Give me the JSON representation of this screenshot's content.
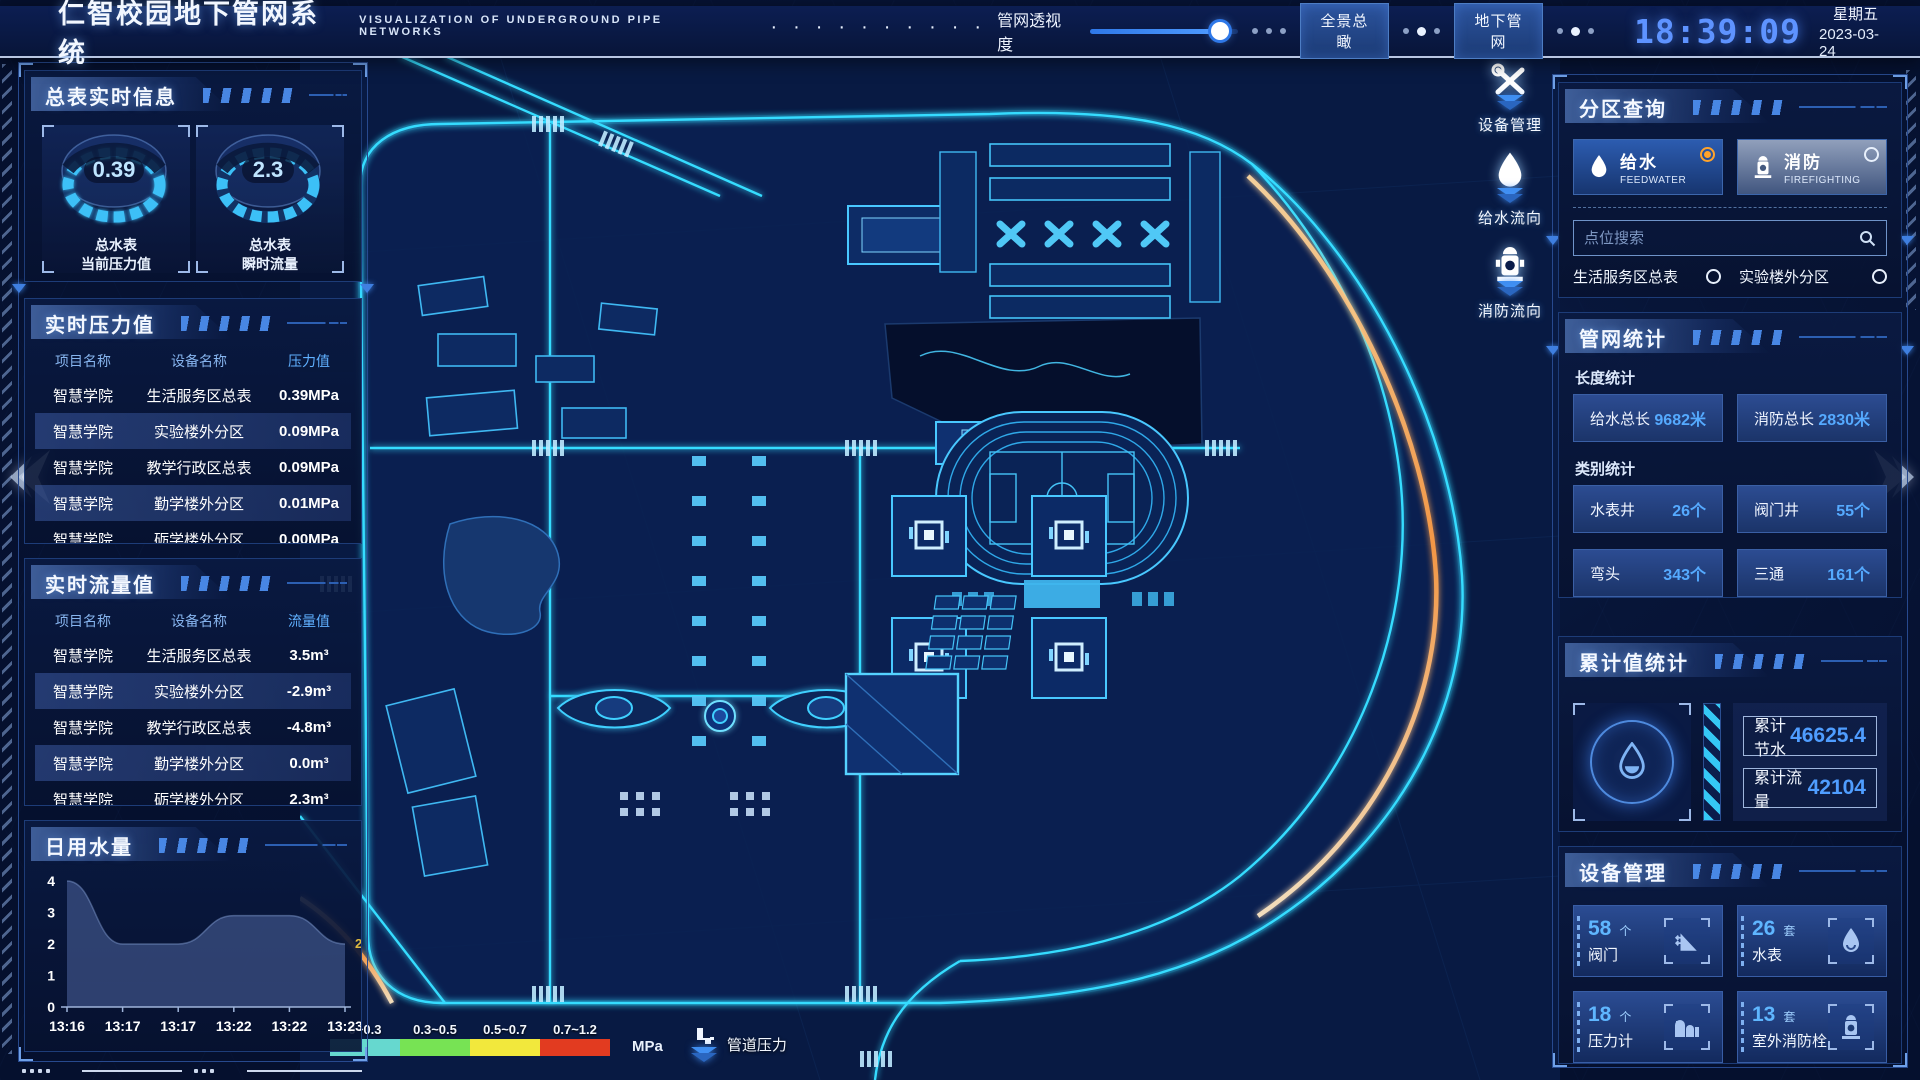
{
  "header": {
    "title_cn": "仁智校园地下管网系统",
    "title_en": "VISUALIZATION OF UNDERGROUND PIPE NETWORKS",
    "opacity_label": "管网透视度",
    "opacity_percent": 88,
    "btn_overview": "全景总瞰",
    "btn_underground": "地下管网",
    "time": "18:39:09",
    "weekday": "星期五",
    "date": "2023-03-24"
  },
  "left": {
    "realtime_info": {
      "title": "总表实时信息",
      "gauges": [
        {
          "value": "0.39",
          "line1": "总水表",
          "line2": "当前压力值"
        },
        {
          "value": "2.3",
          "line1": "总水表",
          "line2": "瞬时流量"
        }
      ]
    },
    "pressure": {
      "title": "实时压力值",
      "headers": [
        "项目名称",
        "设备名称",
        "压力值"
      ],
      "rows": [
        {
          "project": "智慧学院",
          "device": "生活服务区总表",
          "value": "0.39MPa"
        },
        {
          "project": "智慧学院",
          "device": "实验楼外分区",
          "value": "0.09MPa"
        },
        {
          "project": "智慧学院",
          "device": "教学行政区总表",
          "value": "0.09MPa"
        },
        {
          "project": "智慧学院",
          "device": "勤学楼外分区",
          "value": "0.01MPa"
        },
        {
          "project": "智慧学院",
          "device": "砺学楼外分区",
          "value": "0.00MPa"
        }
      ]
    },
    "flow": {
      "title": "实时流量值",
      "headers": [
        "项目名称",
        "设备名称",
        "流量值"
      ],
      "rows": [
        {
          "project": "智慧学院",
          "device": "生活服务区总表",
          "value": "3.5m³"
        },
        {
          "project": "智慧学院",
          "device": "实验楼外分区",
          "value": "-2.9m³"
        },
        {
          "project": "智慧学院",
          "device": "教学行政区总表",
          "value": "-4.8m³"
        },
        {
          "project": "智慧学院",
          "device": "勤学楼外分区",
          "value": "0.0m³"
        },
        {
          "project": "智慧学院",
          "device": "砺学楼外分区",
          "value": "2.3m³"
        }
      ]
    },
    "daily_water_title": "日用水量"
  },
  "chart_data": {
    "type": "area",
    "title": "日用水量",
    "x": [
      "13:16",
      "13:17",
      "13:17",
      "13:22",
      "13:22",
      "13:23"
    ],
    "values": [
      4,
      2,
      2,
      2.9,
      2.9,
      2
    ],
    "yticks": [
      0,
      1,
      2,
      3,
      4
    ],
    "ylim": [
      0,
      4
    ],
    "end_label": "2",
    "end_label_color": "#dfb93f",
    "area_color": "#4e66a0",
    "grid": false,
    "legend_position": "none"
  },
  "map": {
    "legend": {
      "ranges": [
        {
          "label": "0~0.3",
          "color": "#66d8cf"
        },
        {
          "label": "0.3~0.5",
          "color": "#77e354"
        },
        {
          "label": "0.5~0.7",
          "color": "#f2e83c"
        },
        {
          "label": "0.7~1.2",
          "color": "#e23b20"
        }
      ],
      "unit": "MPa",
      "pipe_pressure_label": "管道压力"
    },
    "tools": [
      {
        "label": "设备管理"
      },
      {
        "label": "给水流向"
      },
      {
        "label": "消防流向"
      }
    ]
  },
  "right": {
    "partition": {
      "title": "分区查询",
      "tabs": [
        {
          "cn": "给水",
          "en": "FEEDWATER",
          "selected": true
        },
        {
          "cn": "消防",
          "en": "FIREFIGHTING",
          "selected": false
        }
      ],
      "search_placeholder": "点位搜索",
      "items": [
        "生活服务区总表",
        "实验楼外分区",
        "教学行政区总表",
        "勤学楼外分区",
        "砺学楼外分区",
        "宿舍区泵房"
      ]
    },
    "network_stats": {
      "title": "管网统计",
      "length_title": "长度统计",
      "length": [
        {
          "label": "给水总长",
          "value": "9682米"
        },
        {
          "label": "消防总长",
          "value": "2830米"
        }
      ],
      "category_title": "类别统计",
      "category": [
        {
          "label": "水表井",
          "value": "26个"
        },
        {
          "label": "阀门井",
          "value": "55个"
        },
        {
          "label": "弯头",
          "value": "343个"
        },
        {
          "label": "三通",
          "value": "161个"
        }
      ]
    },
    "totals": {
      "title": "累计值统计",
      "rows": [
        {
          "label": "累计节水",
          "value": "46625.4"
        },
        {
          "label": "累计流量",
          "value": "42104"
        }
      ]
    },
    "devices": {
      "title": "设备管理",
      "cards": [
        {
          "count": "58",
          "unit": "个",
          "label": "阀门"
        },
        {
          "count": "26",
          "unit": "套",
          "label": "水表"
        },
        {
          "count": "18",
          "unit": "个",
          "label": "压力计"
        },
        {
          "count": "13",
          "unit": "套",
          "label": "室外消防栓"
        }
      ]
    }
  }
}
